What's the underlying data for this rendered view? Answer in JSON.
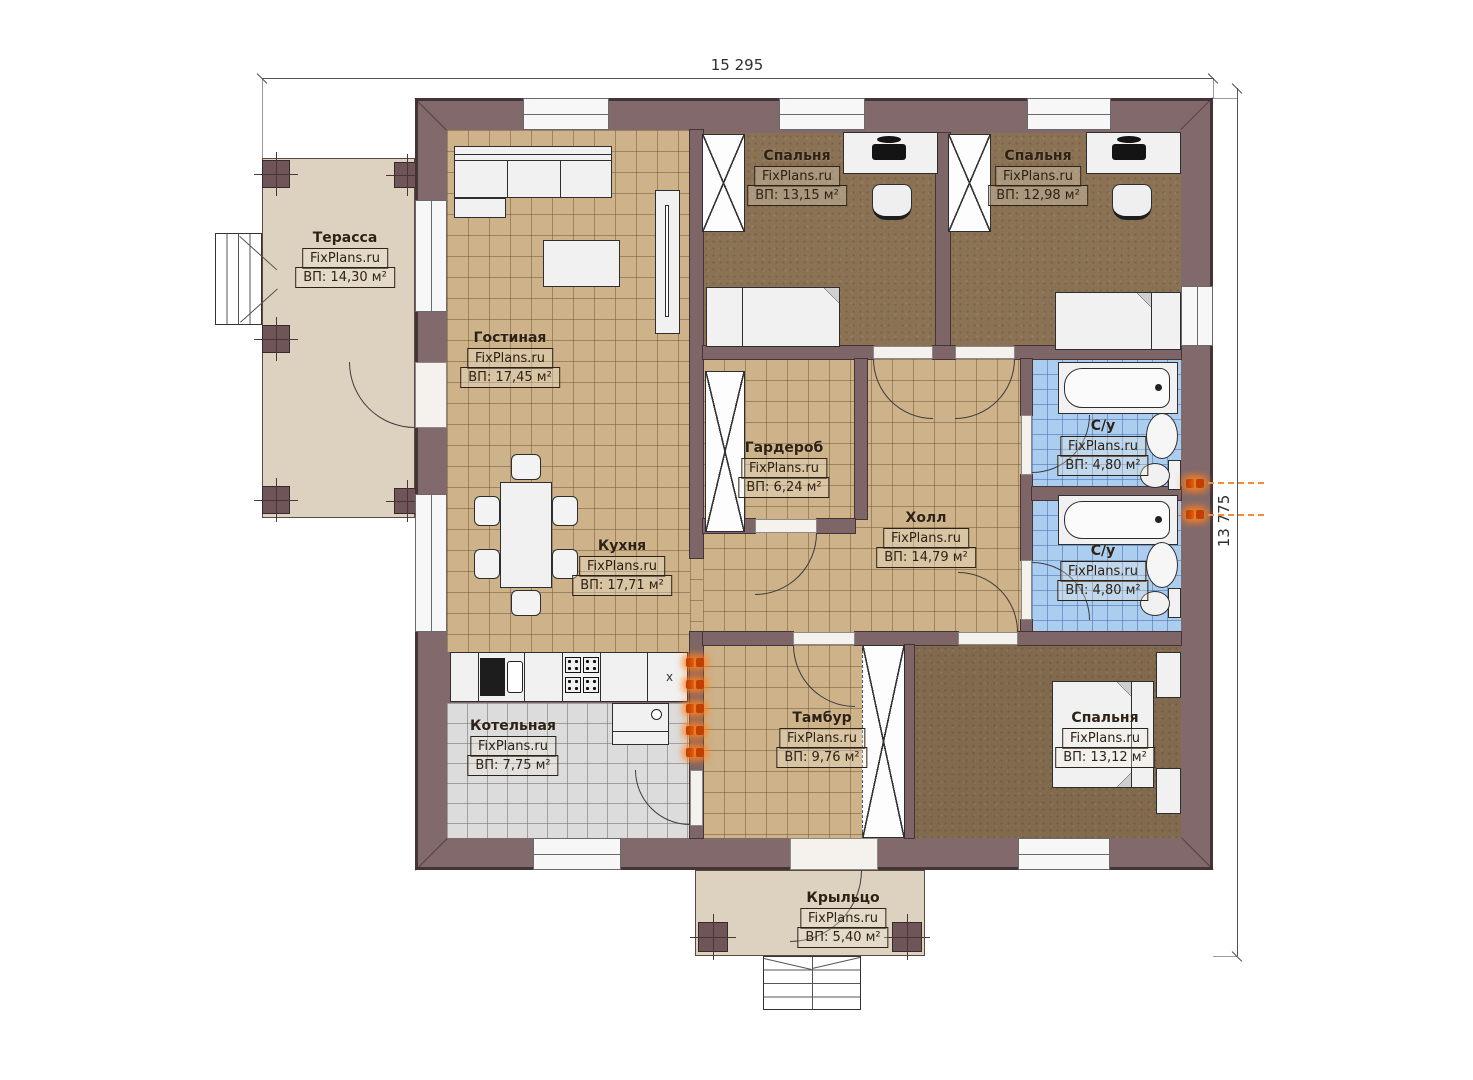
{
  "watermark": "FixPlans.ru",
  "dimensions": {
    "width_label": "15 295",
    "height_label": "13 775"
  },
  "rooms": {
    "terrace": {
      "name": "Терасса",
      "area": "ВП: 14,30 м²"
    },
    "living": {
      "name": "Гостиная",
      "area": "ВП: 17,45 м²"
    },
    "bedroom1": {
      "name": "Спальня",
      "area": "ВП: 13,15 м²"
    },
    "bedroom2": {
      "name": "Спальня",
      "area": "ВП: 12,98 м²"
    },
    "wardrobe": {
      "name": "Гардероб",
      "area": "ВП: 6,24 м²"
    },
    "hall": {
      "name": "Холл",
      "area": "ВП: 14,79 м²"
    },
    "bath1": {
      "name": "С/у",
      "area": "ВП: 4,80 м²"
    },
    "bath2": {
      "name": "С/у",
      "area": "ВП: 4,80 м²"
    },
    "kitchen": {
      "name": "Кухня",
      "area": "ВП: 17,71 м²"
    },
    "boiler": {
      "name": "Котельная",
      "area": "ВП: 7,75 м²"
    },
    "vestibule": {
      "name": "Тамбур",
      "area": "ВП: 9,76 м²"
    },
    "bedroom3": {
      "name": "Спальня",
      "area": "ВП: 13,12 м²"
    },
    "porch": {
      "name": "Крыльцо",
      "area": "ВП: 5,40 м²"
    }
  },
  "symbols": {
    "fridge_mark": "x"
  },
  "colors": {
    "wall": "#82696c",
    "tile": "#cdb28a",
    "bath_tile": "#abcdf0",
    "carpet": "#8b7254",
    "deck": "#ddd2c0",
    "radiator": "#f08c3c"
  }
}
